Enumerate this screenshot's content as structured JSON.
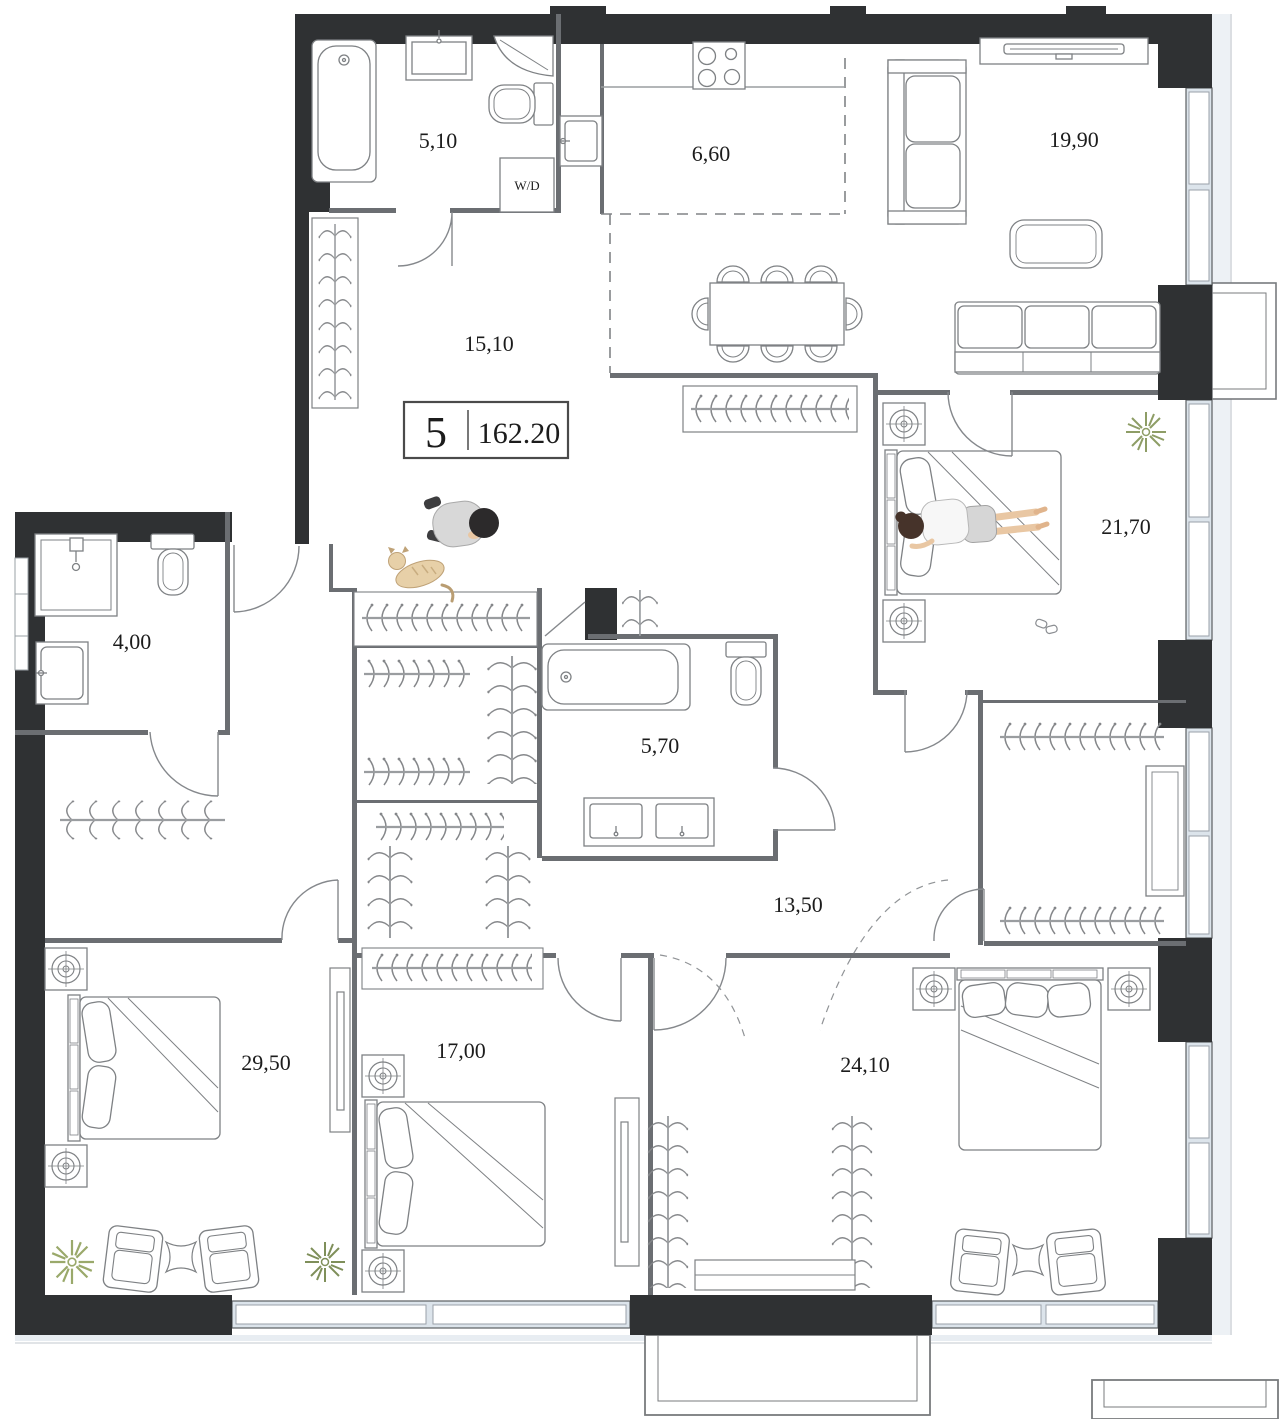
{
  "floorplan": {
    "badge": {
      "room_count": "5",
      "total_area": "162.20"
    },
    "rooms": {
      "bathroom_top": "5,10",
      "kitchen": "6,60",
      "living_room": "19,90",
      "hallway": "15,10",
      "bedroom_master": "21,70",
      "wc": "4,00",
      "bathroom_main": "5,70",
      "corridor": "13,50",
      "bedroom_left": "29,50",
      "bedroom_middle": "17,00",
      "bedroom_right": "24,10"
    },
    "appliances": {
      "washer_dryer": "W/D"
    },
    "colors": {
      "wall": "#2f3133",
      "thin_wall": "#6b6e72",
      "glazing": "#dce4eb",
      "plant_green": "#8e9d66",
      "skin": "#e9c7a3"
    }
  }
}
